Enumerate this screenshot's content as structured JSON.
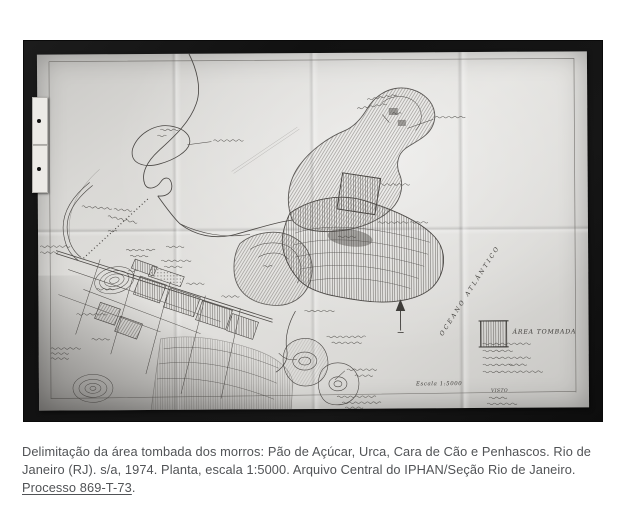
{
  "figure": {
    "map": {
      "ocean_label": "OCEANO ATLÂNTICO",
      "legend_title": "ÁREA TOMBADA",
      "scale_label": "Escala 1:5000",
      "visto_label": "VISTO"
    },
    "caption": {
      "body": "Delimitação da área tombada dos morros: Pão de Açúcar, Urca, Cara de Cão e Penhascos. Rio de Janeiro (RJ). s/a, 1974. Planta, escala 1:5000. Arquivo Central do IPHAN/Seção Rio de Janeiro. ",
      "process": "Processo 869-T-73",
      "period": "."
    },
    "colors": {
      "page_background": "#ffffff",
      "photo_frame": "#141414",
      "paper": "#dcdbd8",
      "ink": "#45433f",
      "caption_text": "#515356"
    }
  }
}
